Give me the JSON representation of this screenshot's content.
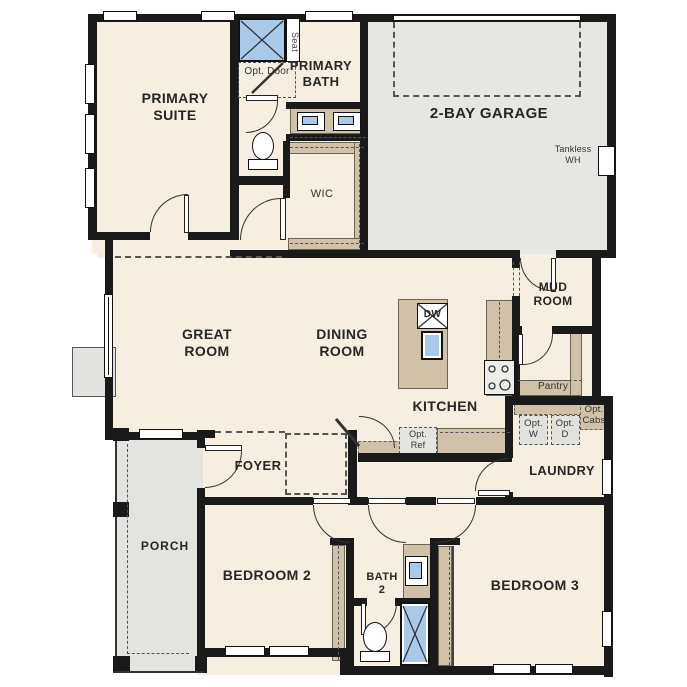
{
  "rooms": {
    "primary_suite": "PRIMARY SUITE",
    "primary_bath": "PRIMARY BATH",
    "wic": "WIC",
    "garage": "2-BAY GARAGE",
    "great_room": "GREAT ROOM",
    "dining_room": "DINING ROOM",
    "kitchen": "KITCHEN",
    "mud_room": "MUD ROOM",
    "laundry": "LAUNDRY",
    "foyer": "FOYER",
    "porch": "PORCH",
    "bedroom_2": "BEDROOM 2",
    "bath_2": "BATH 2",
    "bedroom_3": "BEDROOM 3"
  },
  "fixtures": {
    "seat": "Seat",
    "dishwasher": "DW",
    "tankless_wh": "Tankless WH",
    "pantry": "Pantry"
  },
  "options": {
    "opt_door": "Opt. Door",
    "opt_ref": "Opt. Ref",
    "opt_washer": "Opt. W",
    "opt_dryer": "Opt. D",
    "opt_cabs": "Opt. Cabs"
  },
  "colors": {
    "wall": "#1a1a1a",
    "floor": "#f5eee1",
    "garage_floor": "#e6e6e3",
    "porch_floor": "#e3e3e0",
    "counter": "#cfc2a9",
    "fixture_blue": "#a9c9ea",
    "dashed_line": "#555555",
    "label_text": "#262626"
  }
}
